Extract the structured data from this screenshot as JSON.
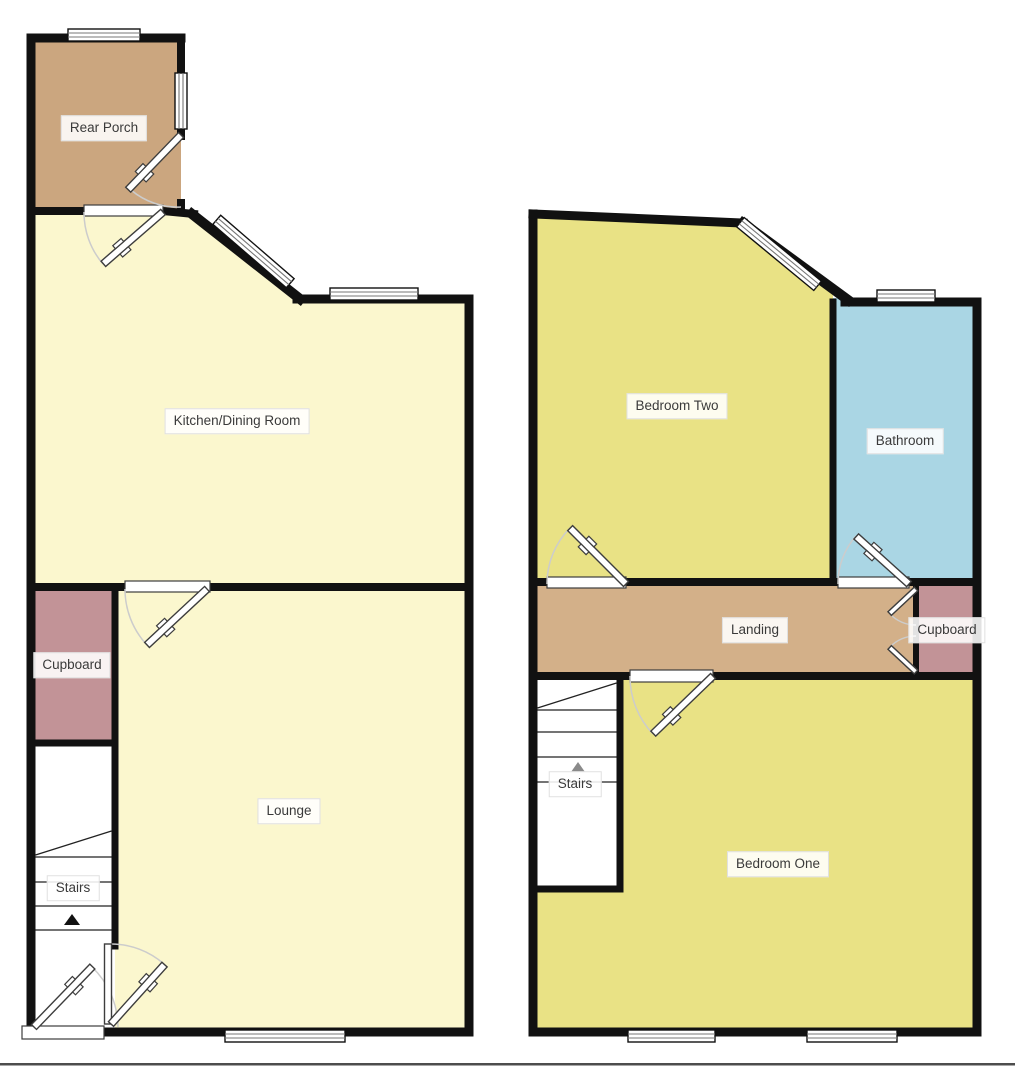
{
  "title": "Two storey house floor plan",
  "floors": [
    {
      "name": "ground-floor",
      "rooms": [
        {
          "label": "Rear Porch"
        },
        {
          "label": "Kitchen/Dining Room"
        },
        {
          "label": "Cupboard"
        },
        {
          "label": "Lounge"
        },
        {
          "label": "Stairs"
        }
      ]
    },
    {
      "name": "first-floor",
      "rooms": [
        {
          "label": "Bedroom Two"
        },
        {
          "label": "Bathroom"
        },
        {
          "label": "Landing"
        },
        {
          "label": "Cupboard"
        },
        {
          "label": "Stairs"
        },
        {
          "label": "Bedroom One"
        }
      ]
    }
  ],
  "icons": {
    "stairs_direction_ground": "up-arrow-icon",
    "stairs_direction_first": "up-arrow-icon"
  },
  "colors": {
    "wall": "#111111",
    "ground_room": "#FBF7CE",
    "first_room": "#E9E285",
    "porch": "#CBA67F",
    "landing": "#D3B089",
    "cupboard": "#C29397",
    "bathroom": "#AAD6E4",
    "door": "#3d3d3d",
    "arc": "#cccccc",
    "arc_dark": "#8a8a8a",
    "tread": "#222222",
    "window_line": "#777777",
    "label_text": "#3a3a3a",
    "label_bg": "rgba(255,255,255,0.88)",
    "label_border": "#e0e0e0",
    "base_line": "#4d4d4d"
  }
}
